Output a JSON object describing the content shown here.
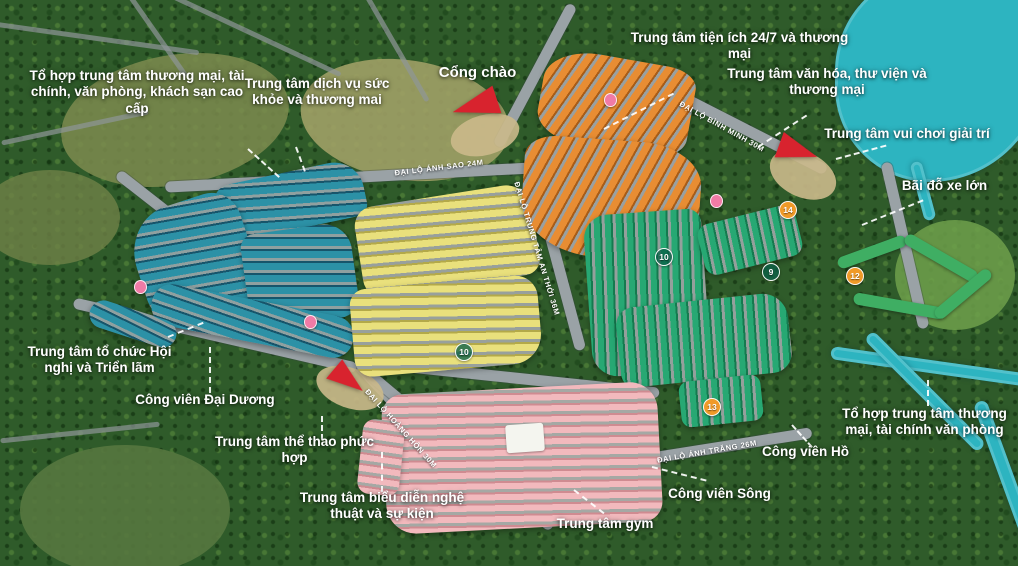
{
  "callouts": {
    "nw_complex": "Tổ hợp trung tâm thương mại, tài chính, văn phòng, khách sạn cao cấp",
    "health": "Trung tâm dịch vụ sức khỏe và thương mai",
    "gate": "Cổng chào",
    "utility": "Trung tâm tiện ích 24/7 và thương mại",
    "culture": "Trung tâm văn hóa, thư viện và thương mại",
    "entertainment": "Trung tâm vui chơi giải trí",
    "parking": "Bãi đỗ xe lớn",
    "conference": "Trung tâm tổ chức Hội nghị và Triển lãm",
    "ocean_park": "Công viên Đại Dương",
    "sports": "Trung tâm thể thao phức hợp",
    "arts": "Trung tâm biểu diễn nghệ thuật và sự kiện",
    "gym": "Trung tâm gym",
    "river_park": "Công viên Sông",
    "lake_park": "Công viên Hồ",
    "se_complex": "Tổ hợp trung tâm thương mại, tài chính văn phòng"
  },
  "roads": {
    "anh_sao": "ĐẠI LỘ ÁNH SAO 24M",
    "trung_tam_an_thoi": "ĐẠI LỘ TRUNG TÂM AN THỚI 36M",
    "binh_minh": "ĐẠI LỘ BÌNH MINH 30M",
    "hoang_hon": "ĐẠI LỘ HOÀNG HÔN 30M",
    "anh_trang": "ĐẠI LỘ ÁNH TRĂNG 26M"
  },
  "zone_badges": {
    "orange_zone": "10",
    "center_zone": "10",
    "green_zone": "9",
    "resort_zone": "12",
    "park_zone": "13",
    "north_zone": "14"
  },
  "colors": {
    "forest": "#2f5b2a",
    "water": "#2db4c0",
    "road": "#9aa2a6",
    "teal_houses": "#2c91a6",
    "yellow_houses": "#e9e07c",
    "orange_houses": "#e88d33",
    "green_houses": "#27a873",
    "pink_houses": "#f2b9bd",
    "marker_red": "#d8232e",
    "label_text": "#ffffff"
  }
}
